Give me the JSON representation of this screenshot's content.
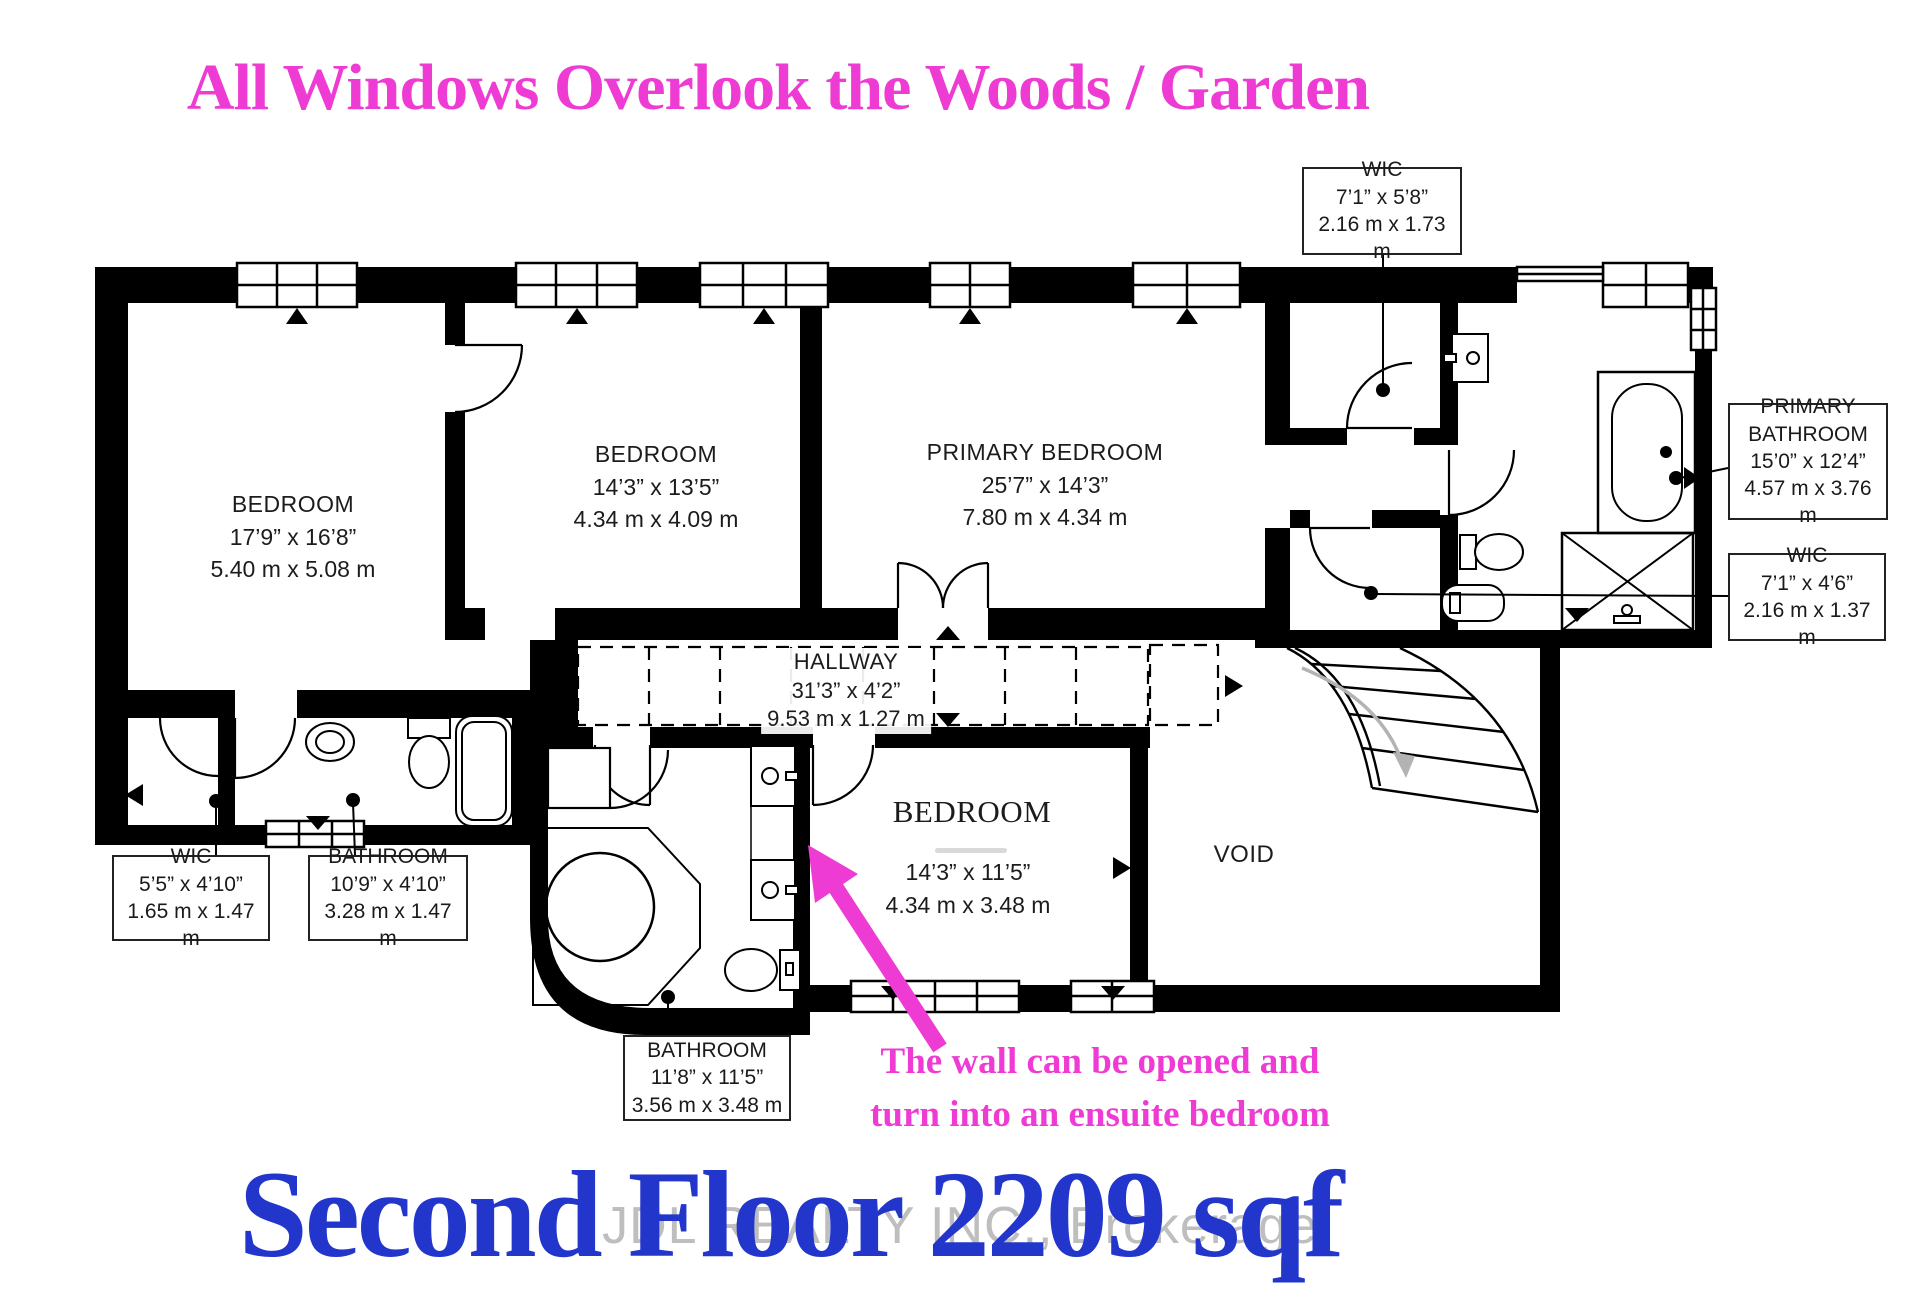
{
  "page": {
    "top_title": "All Windows Overlook the Woods / Garden",
    "bottom_title": "Second Floor 2209 sqf",
    "watermark": "JDL REALTY INC., Brokerage",
    "colors": {
      "accent_magenta": "#ee3bd3",
      "title_blue": "#2236cc",
      "wall_black": "#000000"
    }
  },
  "annotation": {
    "line1": "The wall can be opened and",
    "line2": "turn into an ensuite bedroom"
  },
  "rooms": [
    {
      "name": "BEDROOM",
      "imperial": "17’9” x 16’8”",
      "metric": "5.40 m x 5.08 m"
    },
    {
      "name": "BEDROOM",
      "imperial": "14’3” x 13’5”",
      "metric": "4.34 m x 4.09 m"
    },
    {
      "name": "PRIMARY BEDROOM",
      "imperial": "25’7” x 14’3”",
      "metric": "7.80 m x 4.34 m"
    },
    {
      "name": "HALLWAY",
      "imperial": "31’3” x 4’2”",
      "metric": "9.53 m x 1.27 m"
    },
    {
      "name": "BEDROOM",
      "imperial": "14’3” x 11’5”",
      "metric": "4.34 m x 3.48 m"
    },
    {
      "name": "VOID"
    }
  ],
  "callouts": [
    {
      "name": "WIC",
      "imperial": "7’1” x 5’8”",
      "metric": "2.16 m x 1.73 m"
    },
    {
      "name": "PRIMARY BATHROOM",
      "imperial": "15’0” x 12’4”",
      "metric": "4.57 m x 3.76 m"
    },
    {
      "name": "WIC",
      "imperial": "7’1” x 4’6”",
      "metric": "2.16 m x 1.37 m"
    },
    {
      "name": "WIC",
      "imperial": "5’5” x 4’10”",
      "metric": "1.65 m x 1.47 m"
    },
    {
      "name": "BATHROOM",
      "imperial": "10’9” x 4’10”",
      "metric": "3.28 m x 1.47 m"
    },
    {
      "name": "BATHROOM",
      "imperial": "11’8” x 11’5”",
      "metric": "3.56 m x 3.48 m"
    }
  ]
}
